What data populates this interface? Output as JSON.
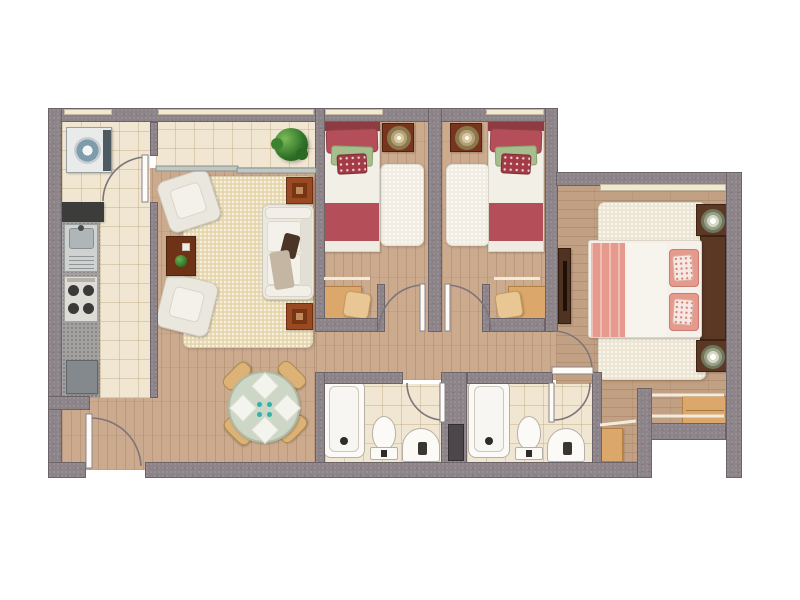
{
  "palette": {
    "background": "#ffffff",
    "wall": "#8d8489",
    "window_strip": "#f1e8d2",
    "wood_floor": "#cbaa8d",
    "wood_floor_master": "#c2a083",
    "tile_floor": "#f0e6d2",
    "rug_living": "#e6d6ad",
    "rug_white": "#f1ece1",
    "rug_master": "#ece5d2",
    "bed_red": "#b44f59",
    "bed_red_dark": "#8e3c42",
    "pillow_green": "#a6bd8d",
    "bed_pink": "#e69a8e",
    "sofa_white": "#ebe8e0",
    "wood_furniture": "#dca76a",
    "wood_dark": "#5b3824",
    "side_table_rust": "#9a4a22",
    "dining_table": "#ccd7c6",
    "teal_dot": "#2fb3ac",
    "plant_green": "#2f7328",
    "fixture_white": "#fbfaf7",
    "shaft_dark": "#4c4549",
    "door_arc": "#7d757a",
    "washer_blue": "#7f9cab",
    "counter_dark": "#3c3c3a",
    "granite": "#a3a1a0",
    "glass_door": "#c2c7c2"
  },
  "plan": {
    "rooms": [
      {
        "name": "kitchen",
        "furniture": [
          "washing-machine",
          "dark-countertop",
          "granite-countertop",
          "sink",
          "stove",
          "appliance"
        ]
      },
      {
        "name": "balcony",
        "furniture": [
          "plant",
          "sliding-glass-door"
        ]
      },
      {
        "name": "living-room",
        "furniture": [
          "rug",
          "armchair",
          "armchair",
          "coffee-table",
          "sofa",
          "side-table",
          "side-table"
        ]
      },
      {
        "name": "dining-area",
        "furniture": [
          "round-table",
          "placemats",
          "chair",
          "chair",
          "chair",
          "chair"
        ]
      },
      {
        "name": "entry",
        "furniture": [
          "entry-door"
        ]
      },
      {
        "name": "bedroom-1",
        "furniture": [
          "single-bed",
          "nightstand",
          "lamp",
          "rug",
          "desk",
          "chair"
        ]
      },
      {
        "name": "bedroom-2",
        "furniture": [
          "single-bed",
          "nightstand",
          "lamp",
          "rug",
          "desk",
          "chair"
        ]
      },
      {
        "name": "bathroom-1",
        "furniture": [
          "bathtub",
          "toilet",
          "basin"
        ]
      },
      {
        "name": "bathroom-2",
        "furniture": [
          "bathtub",
          "toilet",
          "basin"
        ]
      },
      {
        "name": "duct-shaft",
        "furniture": []
      },
      {
        "name": "master-bedroom",
        "furniture": [
          "double-bed",
          "headboard",
          "nightstand",
          "nightstand",
          "lamp",
          "lamp",
          "dresser",
          "rug"
        ]
      },
      {
        "name": "walk-in-closet",
        "furniture": [
          "clothes-rail",
          "clothes-rail",
          "drawer-cabinet",
          "small-cabinet"
        ]
      }
    ]
  }
}
